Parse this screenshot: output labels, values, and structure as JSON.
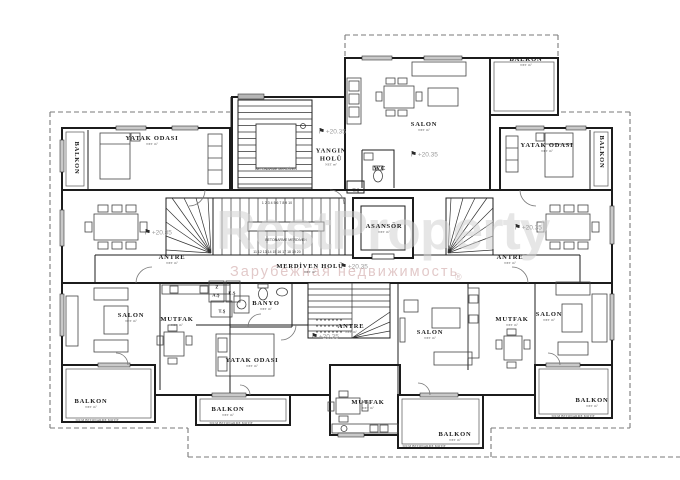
{
  "watermark": {
    "brand": "RestProperty",
    "registered_mark": "®",
    "subtitle": "Зарубежная недвижимость"
  },
  "elevation_marker": {
    "flag_icon": "⚑",
    "value": "+20.35"
  },
  "stair_notes": {
    "concrete_stair": "BETONARME MERDİVEN",
    "tread_numbers_upper": "1 2 3 4 5 6 7 8 9 10",
    "tread_numbers_lower": "11 12 13 14 15 16 17 18 19 20"
  },
  "balcony_note": "30CM BETONARME MOTİF",
  "area_note": "NET m²",
  "rooms": {
    "balkon_top_left": {
      "label": "BALKON"
    },
    "yatak_odasi_top_left": {
      "label": "YATAK ODASI"
    },
    "yangin_holu": {
      "label": "YANGIN HOLÜ"
    },
    "wc": {
      "label": "WC"
    },
    "ts_upper": {
      "label": "T.Ş"
    },
    "salon_top": {
      "label": "SALON"
    },
    "balkon_top_right": {
      "label": "BALKON"
    },
    "yatak_odasi_top_right": {
      "label": "YATAK ODASI"
    },
    "balkon_right": {
      "label": "BALKON"
    },
    "asansor": {
      "label": "ASANSÖR"
    },
    "merdiven_holu": {
      "label": "MERDİVEN HOLÜ"
    },
    "antre_left": {
      "label": "ANTRE"
    },
    "antre_right": {
      "label": "ANTRE"
    },
    "salon_left": {
      "label": "SALON"
    },
    "mutfak_left": {
      "label": "MUTFAK"
    },
    "balkon_bottom_left": {
      "label": "BALKON"
    },
    "banyo": {
      "label": "BANYO"
    },
    "closet_z": {
      "label": "Z"
    },
    "closet_as": {
      "label": "A.Ş"
    },
    "closet_es": {
      "label": "E.Ş"
    },
    "closet_ts": {
      "label": "T.Ş"
    },
    "yatak_odasi_bottom": {
      "label": "YATAK ODASI"
    },
    "balkon_bottom_center_left": {
      "label": "BALKON"
    },
    "antre_bottom": {
      "label": "ANTRE"
    },
    "mutfak_bottom": {
      "label": "MUTFAK"
    },
    "balkon_bottom_center": {
      "label": "BALKON"
    },
    "salon_bottom": {
      "label": "SALON"
    },
    "mutfak_right": {
      "label": "MUTFAK"
    },
    "salon_right": {
      "label": "SALON"
    },
    "balkon_bottom_right": {
      "label": "BALKON"
    }
  }
}
